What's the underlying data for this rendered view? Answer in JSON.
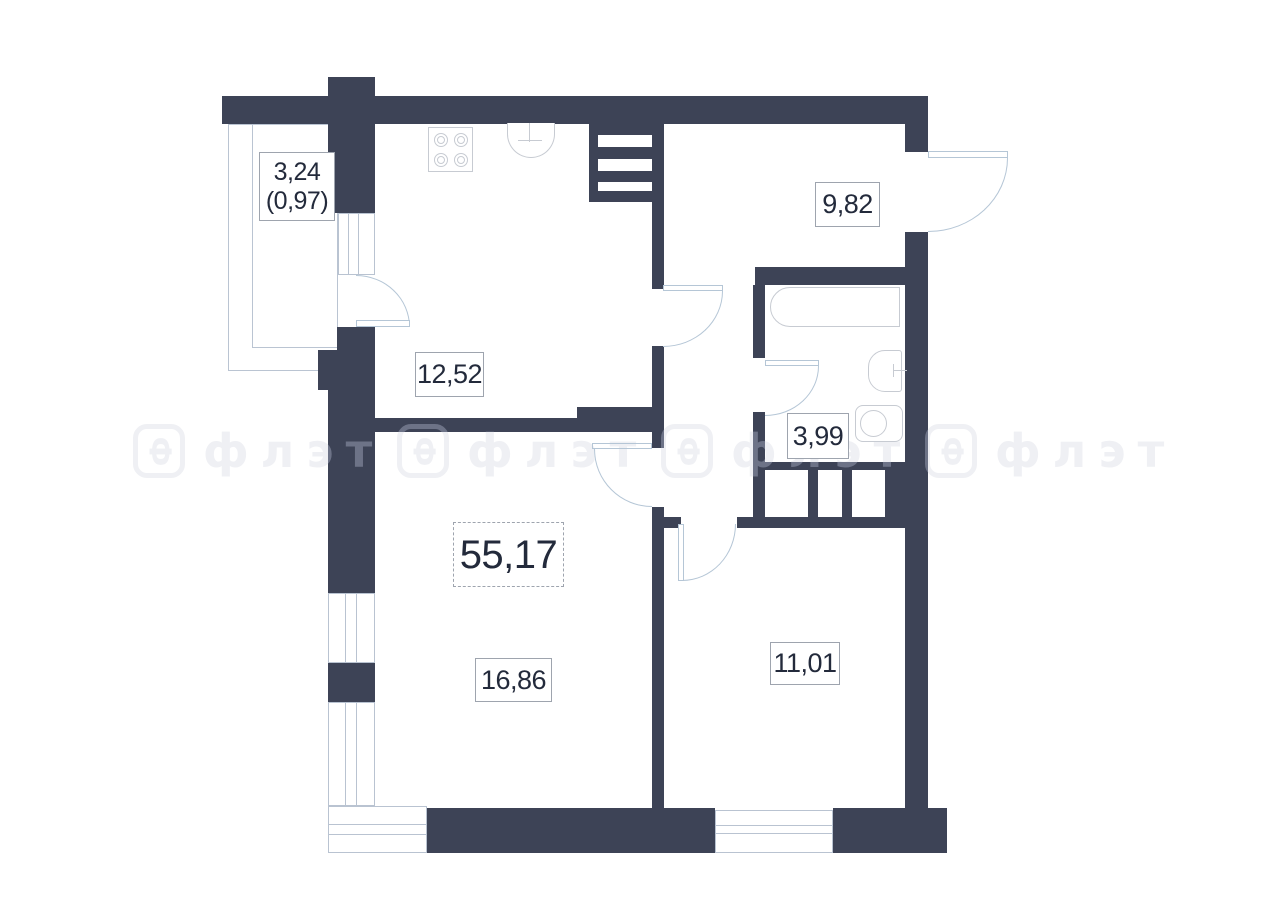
{
  "floorplan": {
    "total_area_label": "55,17",
    "rooms": [
      {
        "name": "balcony",
        "area": "3,24",
        "area_reduced": "(0,97)"
      },
      {
        "name": "kitchen",
        "area": "12,52"
      },
      {
        "name": "hallway",
        "area": "9,82"
      },
      {
        "name": "bathroom",
        "area": "3,99"
      },
      {
        "name": "living-room",
        "area": "16,86"
      },
      {
        "name": "bedroom",
        "area": "11,01"
      }
    ],
    "watermark": {
      "icon_letter": "Ф",
      "text": "флэт"
    },
    "colors": {
      "wall": "#3d4356",
      "door_line": "#b5c6d6",
      "window_line": "#b9c3d1",
      "fixture_line": "#c7cbd2",
      "label_text": "#232a3b",
      "label_border": "#9ea4ae"
    }
  }
}
